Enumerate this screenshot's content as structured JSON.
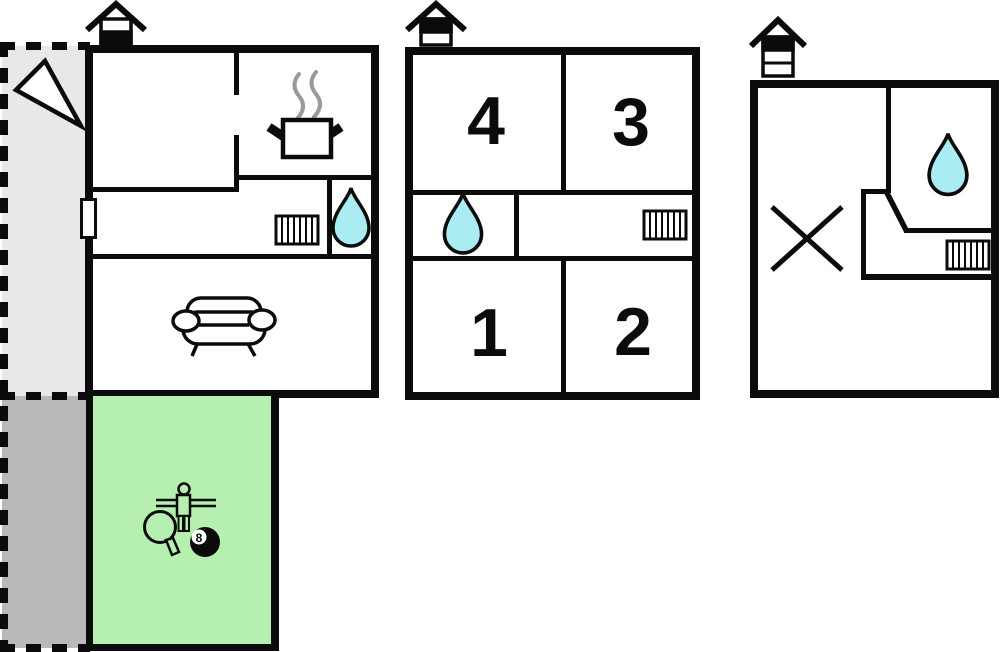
{
  "page": {
    "title": "Property floor plan"
  },
  "colors": {
    "wall": "#0b0b0b",
    "paper": "#ffffff",
    "terrace-light": "#e8e8e8",
    "terrace-dark": "#b9b9b9",
    "green": "#b5f0b1",
    "cyan": "#a9edf3",
    "steam": "#999999"
  },
  "rooms": {
    "bedroom_4": "4",
    "bedroom_3": "3",
    "bedroom_1": "1",
    "bedroom_2": "2"
  },
  "game_room": {
    "eight_ball_label": "8"
  },
  "icons": {
    "floor_indicator_1": "house-level-indicator-lower-floor",
    "floor_indicator_2": "house-level-indicator-upper-floor",
    "floor_indicator_3": "house-level-indicator-top-floor",
    "direction_arrow": "direction-arrow",
    "cooking_pot": "cooking-pot-with-steam",
    "radiator": "radiator",
    "water_drop": "water-drop",
    "sofa": "sofa",
    "foosball_player": "foosball-player",
    "paddle": "table-tennis-paddle",
    "eight_ball": "billiard-eight-ball",
    "cross": "cross-mark"
  }
}
